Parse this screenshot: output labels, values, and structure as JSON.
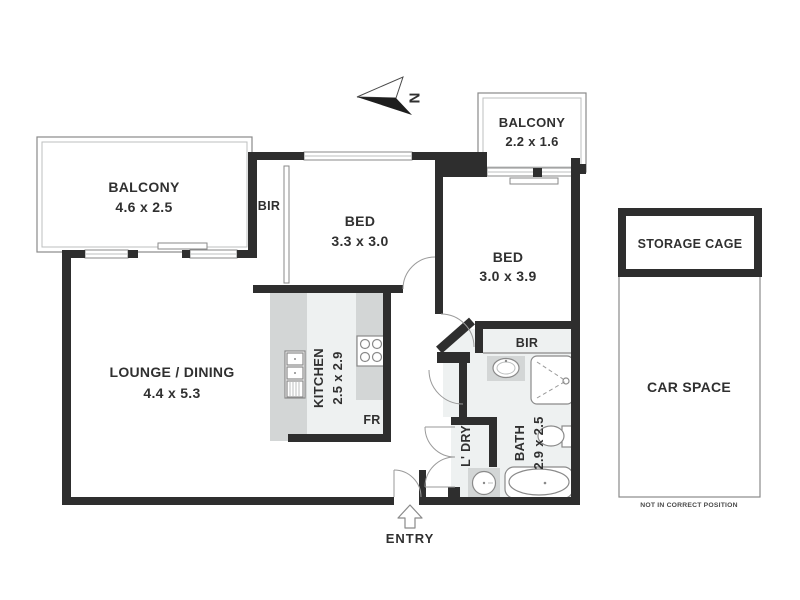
{
  "north": {
    "label": "N"
  },
  "entry": {
    "label": "ENTRY"
  },
  "rooms": {
    "balcony_top_left": {
      "name": "BALCONY",
      "dims": "4.6 x 2.5"
    },
    "balcony_top_right": {
      "name": "BALCONY",
      "dims": "2.2 x 1.6"
    },
    "bed_1": {
      "name": "BED",
      "dims": "3.3 x 3.0"
    },
    "bed_2": {
      "name": "BED",
      "dims": "3.0 x 3.9"
    },
    "lounge_dining": {
      "name": "LOUNGE / DINING",
      "dims": "4.4 x 5.3"
    },
    "kitchen": {
      "name": "KITCHEN",
      "dims": "2.5 x 2.9"
    },
    "bath": {
      "name": "BATH",
      "dims": "2.9 x 2.5"
    },
    "laundry": {
      "name": "L' DRY"
    },
    "robe_bed1": {
      "name": "BIR"
    },
    "robe_bed2": {
      "name": "BIR"
    },
    "fridge": {
      "name": "FR"
    }
  },
  "outbuildings": {
    "storage_cage": {
      "name": "STORAGE CAGE"
    },
    "car_space": {
      "name": "CAR SPACE",
      "note": "NOT IN CORRECT POSITION"
    }
  },
  "colors": {
    "wall": "#2e2e2e",
    "wet_floor": "#eef1f1",
    "counter": "#d3d6d6",
    "thin_line": "#8a8a8a",
    "text": "#303030",
    "background": "#ffffff"
  }
}
